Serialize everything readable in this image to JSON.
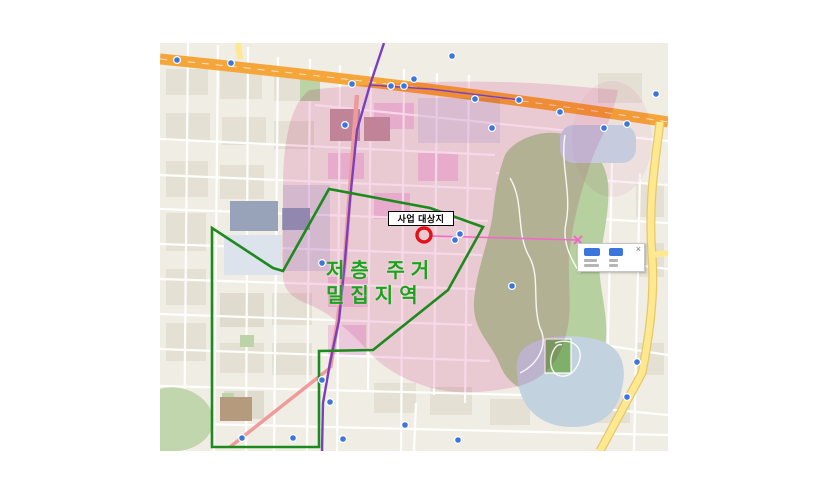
{
  "map": {
    "overlay_labels": {
      "site": "사업 대상지",
      "density_line1": "저층 주거",
      "density_line2": "밀집지역"
    },
    "popup": {
      "close_label": "×"
    },
    "colors": {
      "density_text": "#1ca21c",
      "boundary_polygon": "#1d8a1d",
      "highlight_overlay": "#f2b9d9",
      "campus_overlay": "#cdb3e3",
      "main_road": "#f5a63b",
      "secondary_road": "#ffe88f",
      "inner_road": "#ef9b9b",
      "subway_line": "#7a3fc0",
      "site_marker_ring": "#e31219",
      "measure_line": "#f468cc",
      "transit_marker": "#3b76dd",
      "park": "#b7d0a0",
      "water": "#c3d2df",
      "map_background": "#f0ede5"
    }
  }
}
